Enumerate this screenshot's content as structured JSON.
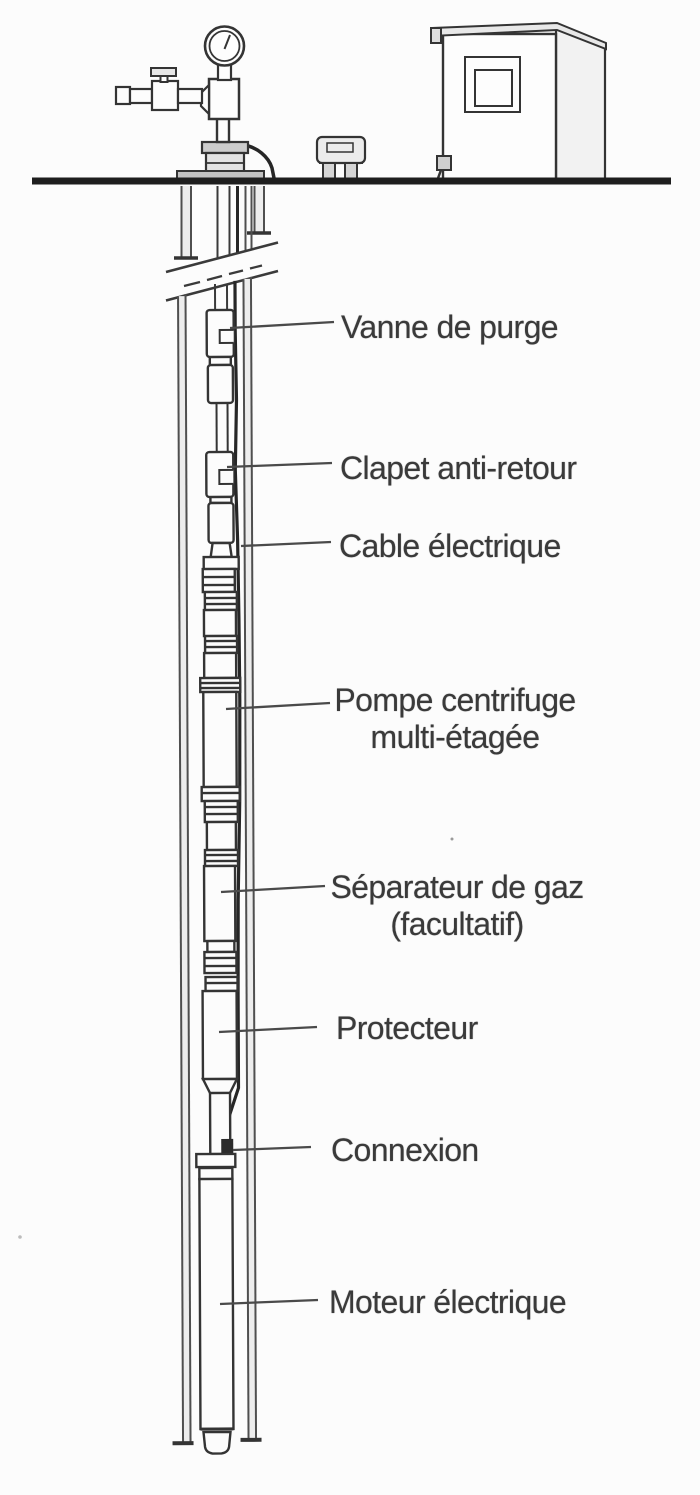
{
  "figure": {
    "kind": "technical line drawing",
    "subject_labels_language": "French"
  },
  "colors": {
    "ink": "#3a3a3a",
    "outline": "#343434",
    "leader_line": "#4a4a4a",
    "ground_line": "#1e1e1e",
    "cable": "#262626",
    "background": "#fcfcfc"
  },
  "annotations": {
    "vanne": {
      "text": "Vanne de purge"
    },
    "clapet": {
      "text": "Clapet anti-retour"
    },
    "cable": {
      "text": "Cable électrique"
    },
    "pompe": {
      "line1": "Pompe centrifuge",
      "line2": "multi-étagée"
    },
    "separateur": {
      "line1": "Séparateur de gaz",
      "line2": "(facultatif)"
    },
    "protecteur": {
      "text": "Protecteur"
    },
    "connexion": {
      "text": "Connexion"
    },
    "moteur": {
      "text": "Moteur électrique"
    }
  }
}
